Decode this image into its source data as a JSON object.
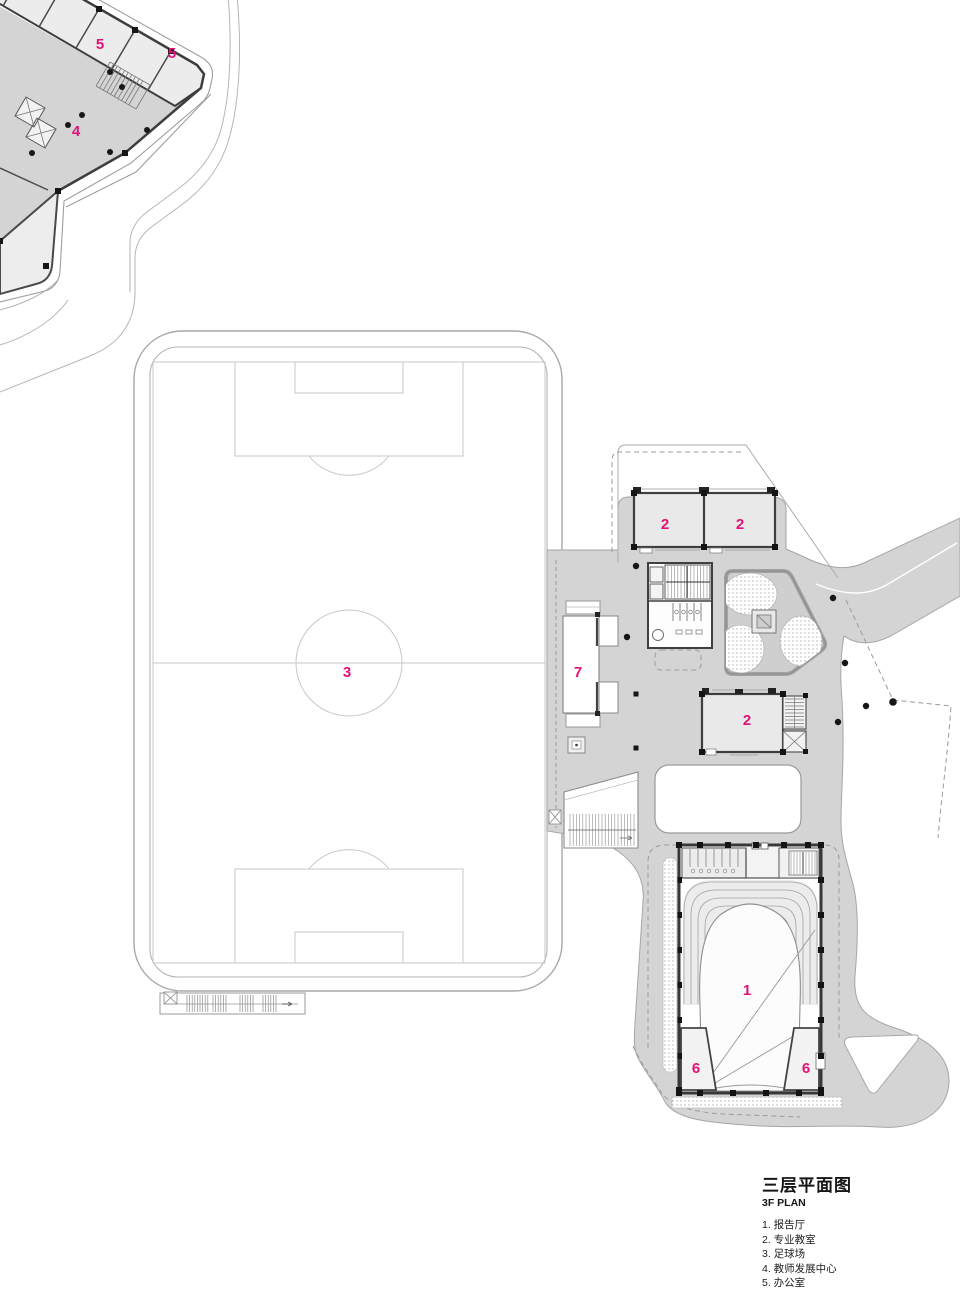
{
  "drawing": {
    "title": "三层平面图",
    "subtitle": "3F PLAN",
    "legend": [
      "1. 报告厅",
      "2. 专业教室",
      "3. 足球场",
      "4. 教师发展中心",
      "5. 办公室",
      "6. 设备用房",
      "7. 主席台"
    ],
    "room_labels": [
      {
        "number": "4",
        "name": "教师发展中心"
      },
      {
        "number": "5",
        "name": "办公室"
      },
      {
        "number": "5",
        "name": "办公室"
      },
      {
        "number": "3",
        "name": "足球场"
      },
      {
        "number": "7",
        "name": "主席台"
      },
      {
        "number": "2",
        "name": "专业教室"
      },
      {
        "number": "2",
        "name": "专业教室"
      },
      {
        "number": "2",
        "name": "专业教室"
      },
      {
        "number": "1",
        "name": "报告厅"
      },
      {
        "number": "6",
        "name": "设备用房"
      },
      {
        "number": "6",
        "name": "设备用房"
      }
    ],
    "colors": {
      "accent": "#e31278",
      "deck": "#d4d4d4",
      "room_fill": "#e9e9e9",
      "wall": "#3d3d3d"
    }
  }
}
